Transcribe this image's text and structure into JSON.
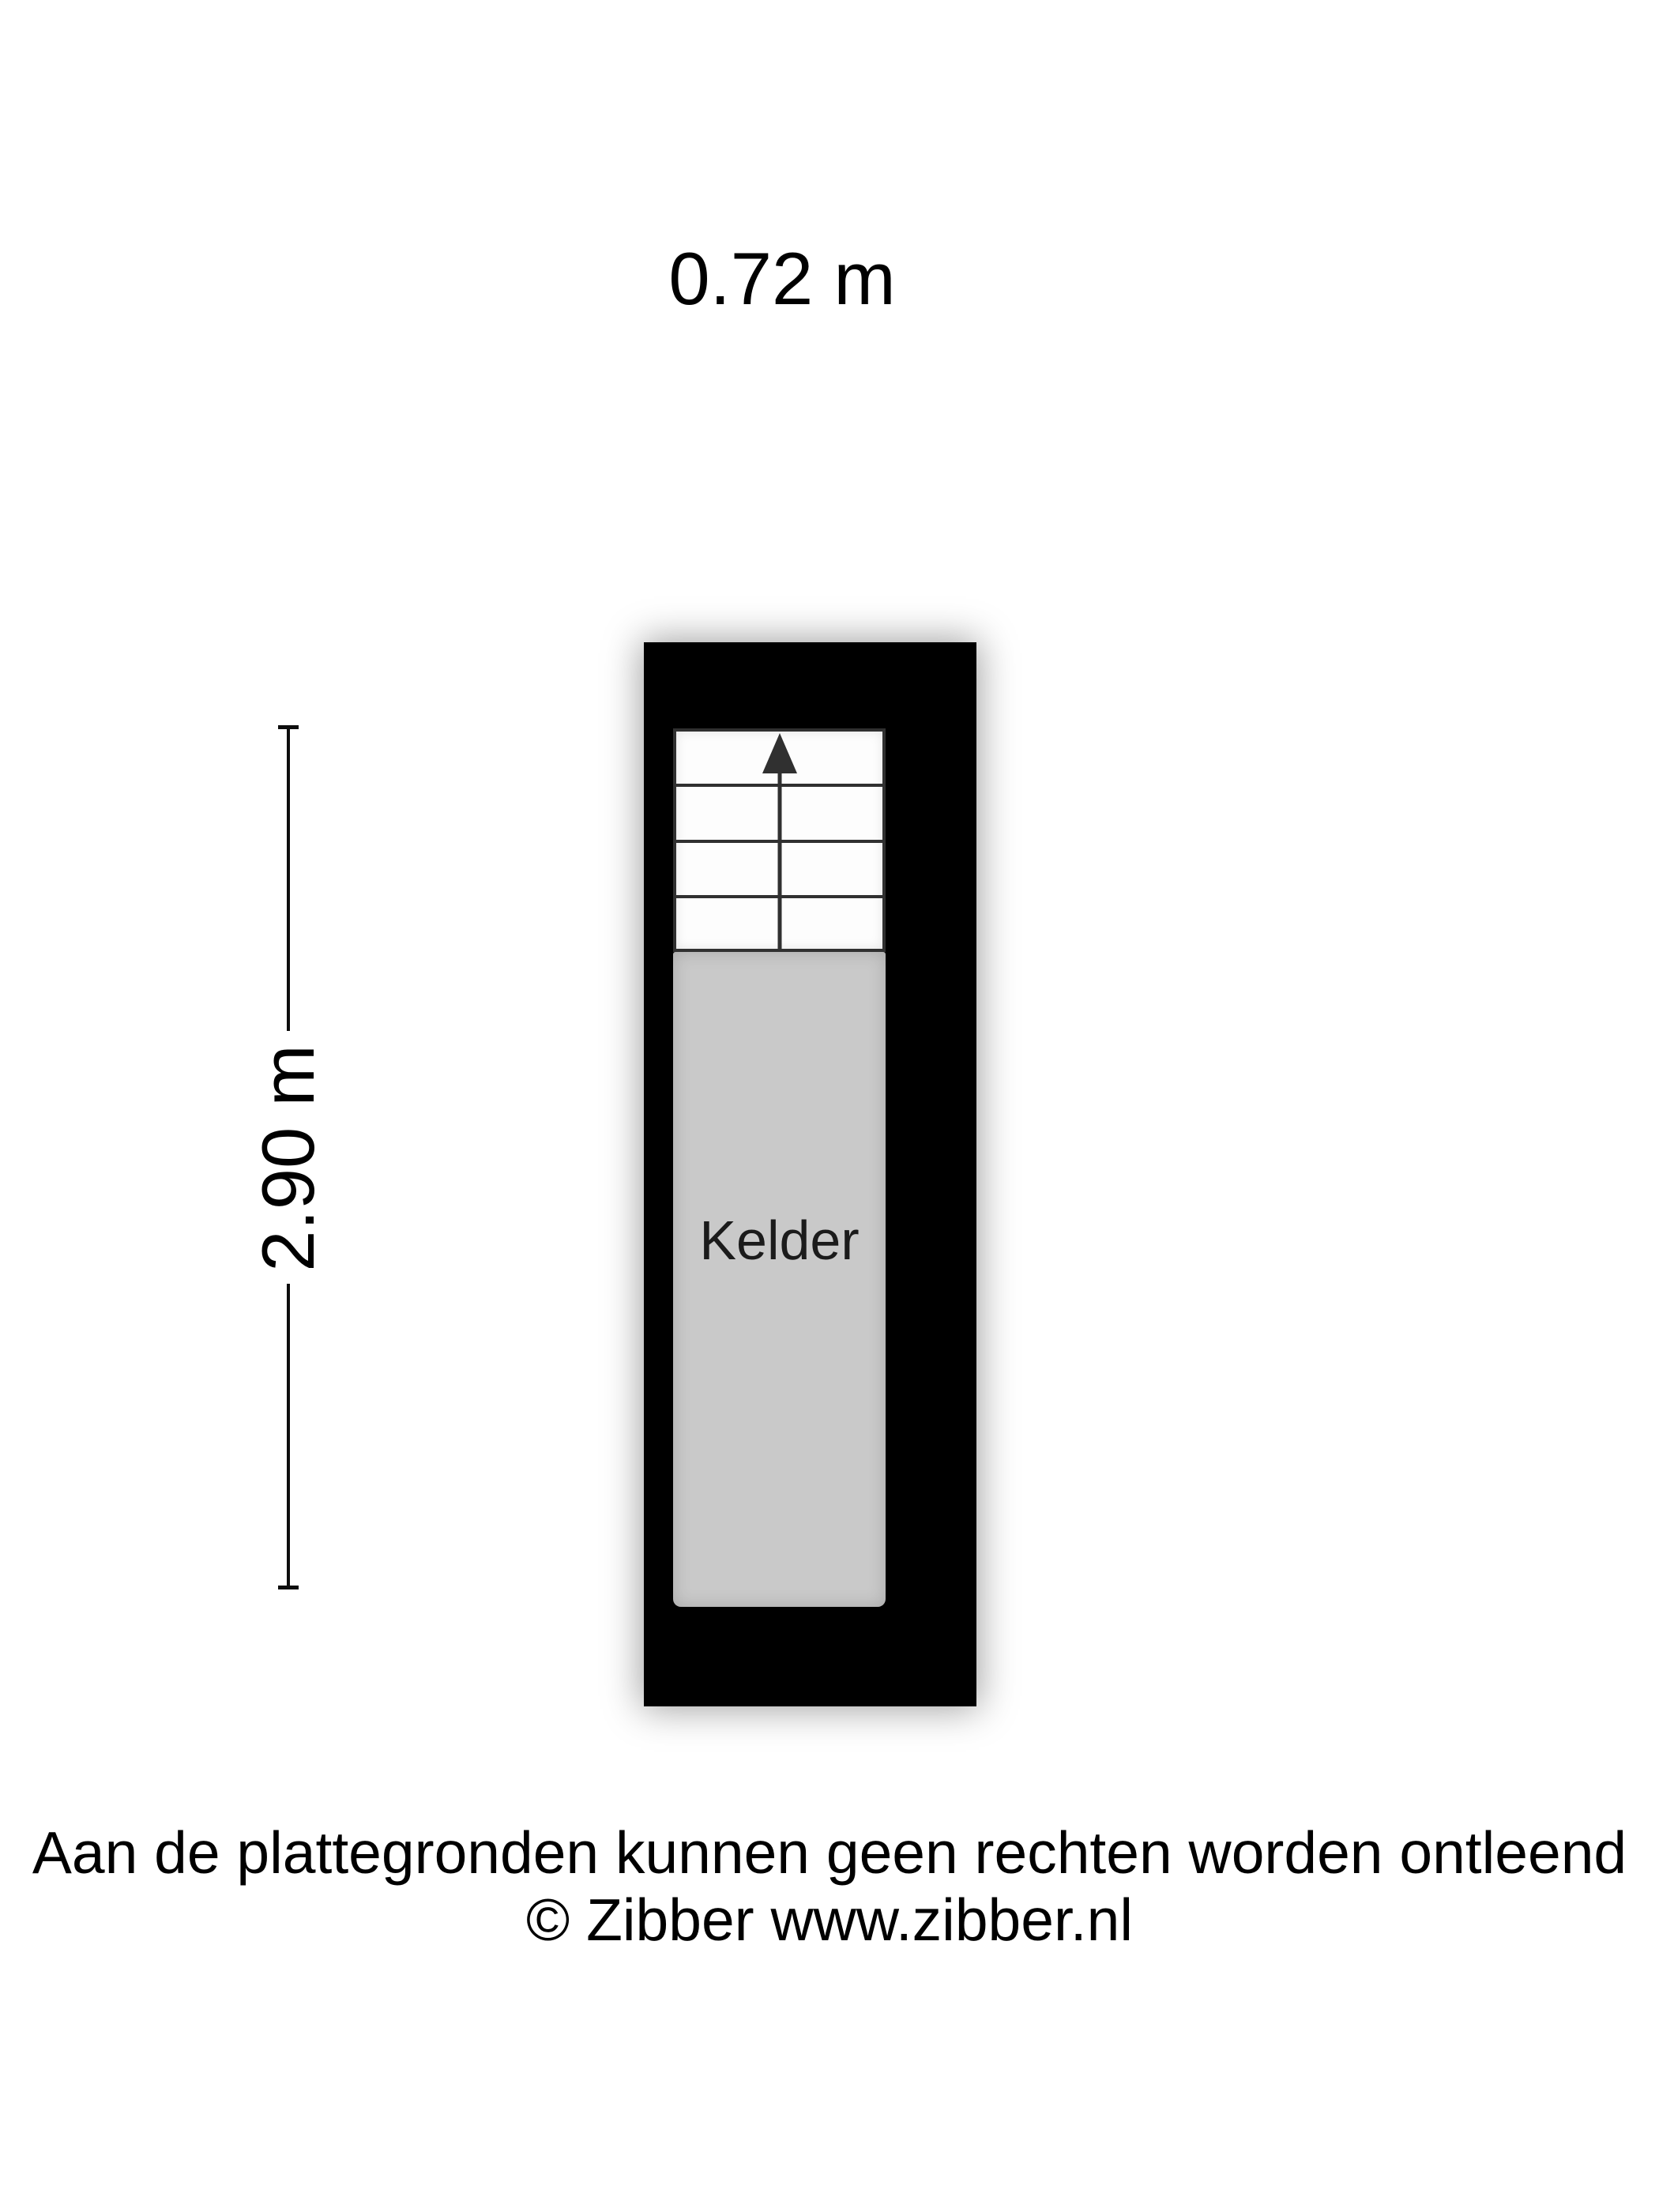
{
  "floorplan": {
    "width_label": "0.72 m",
    "height_label": "2.90 m",
    "room_label": "Kelder",
    "stairs": {
      "steps": 4,
      "direction": "up",
      "arrow_icon": "up-arrow"
    },
    "colors": {
      "page_bg": "#ffffff",
      "wall": "#000000",
      "room_fill": "#c9c9c9",
      "stair_line": "#303030",
      "line": "#0d0d0d",
      "text": "#000000"
    }
  },
  "footer": {
    "line1": "Aan de plattegronden kunnen geen rechten worden ontleend",
    "line2": "© Zibber www.zibber.nl"
  }
}
